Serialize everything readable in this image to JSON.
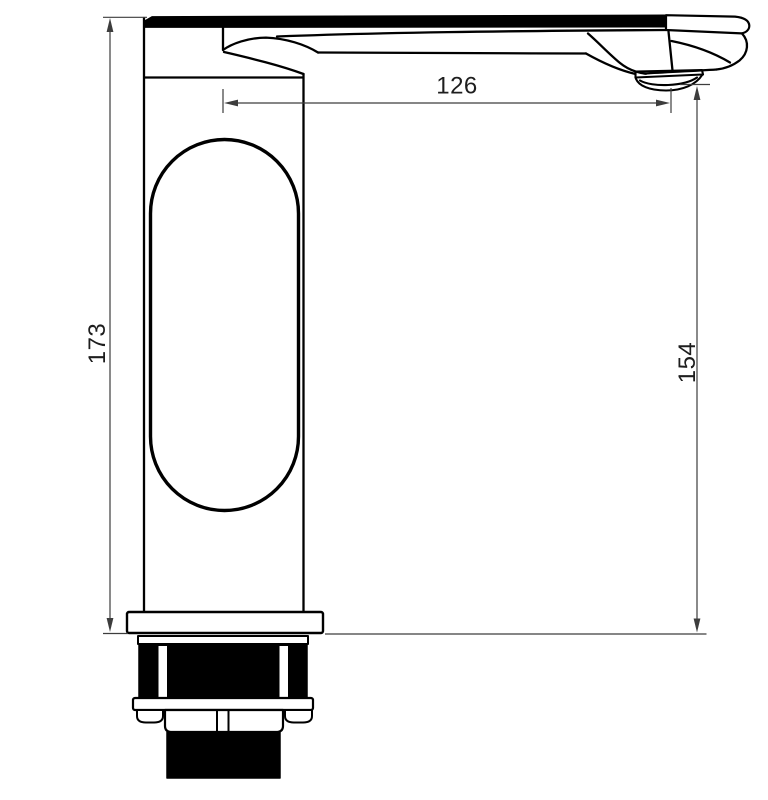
{
  "drawing": {
    "dimensions": {
      "total_height": "173",
      "spout_reach": "126",
      "outlet_height": "154"
    },
    "colors": {
      "outline": "#000000",
      "dimension_line": "#3d3d3d",
      "label_text": "#1e1e1e",
      "background": "#ffffff"
    }
  }
}
